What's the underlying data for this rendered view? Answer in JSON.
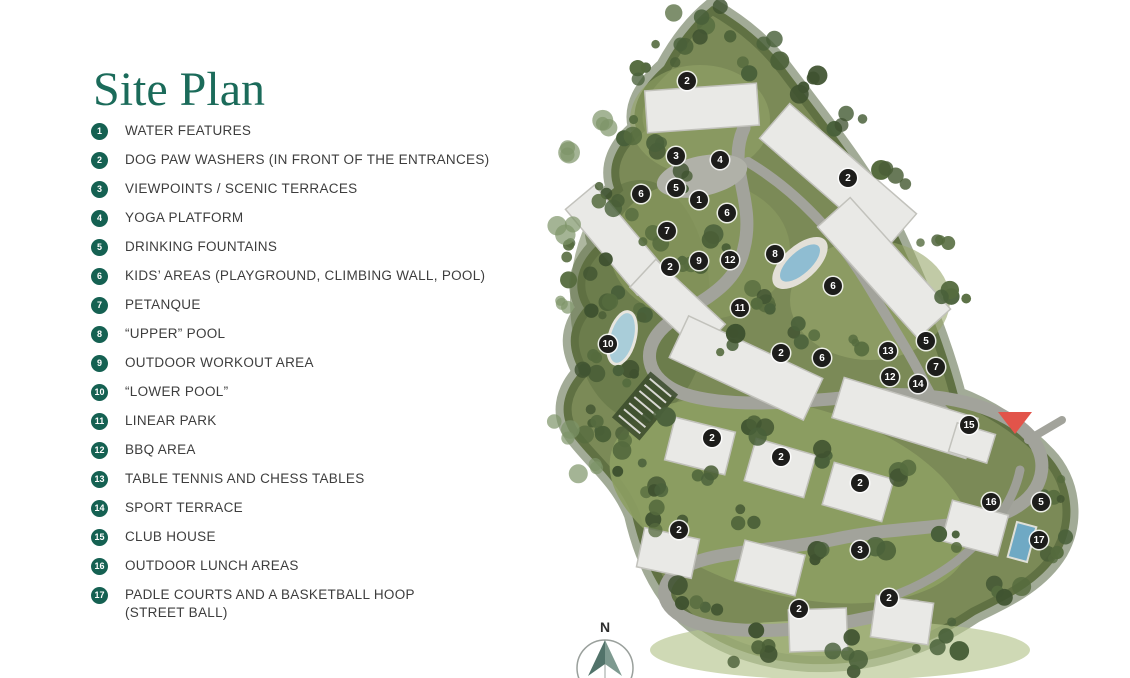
{
  "page": {
    "title": "Site Plan"
  },
  "legend": {
    "badge_color": "#156152",
    "items": [
      {
        "num": "1",
        "label": "WATER FEATURES"
      },
      {
        "num": "2",
        "label": "DOG PAW WASHERS (IN FRONT OF THE ENTRANCES)"
      },
      {
        "num": "3",
        "label": "VIEWPOINTS / SCENIC TERRACES"
      },
      {
        "num": "4",
        "label": "YOGA PLATFORM"
      },
      {
        "num": "5",
        "label": "DRINKING FOUNTAINS"
      },
      {
        "num": "6",
        "label": "KIDS’ AREAS (PLAYGROUND, CLIMBING WALL, POOL)"
      },
      {
        "num": "7",
        "label": "PETANQUE"
      },
      {
        "num": "8",
        "label": "“UPPER” POOL"
      },
      {
        "num": "9",
        "label": "OUTDOOR WORKOUT AREA"
      },
      {
        "num": "10",
        "label": "“LOWER POOL”"
      },
      {
        "num": "11",
        "label": "LINEAR PARK"
      },
      {
        "num": "12",
        "label": "BBQ AREA"
      },
      {
        "num": "13",
        "label": "TABLE TENNIS AND CHESS TABLES"
      },
      {
        "num": "14",
        "label": "SPORT TERRACE"
      },
      {
        "num": "15",
        "label": "CLUB HOUSE"
      },
      {
        "num": "16",
        "label": "OUTDOOR LUNCH AREAS"
      },
      {
        "num": "17",
        "label": "PADLE COURTS AND A BASKETBALL HOOP\n(STREET BALL)"
      }
    ]
  },
  "map": {
    "compass_label": "N",
    "marker_color": "#1d1d1b",
    "entrance_marker_color": "#e2544a",
    "title_color": "#1b6b5a",
    "markers": [
      {
        "label": "2",
        "x": 687,
        "y": 81
      },
      {
        "label": "3",
        "x": 676,
        "y": 156
      },
      {
        "label": "4",
        "x": 720,
        "y": 160
      },
      {
        "label": "2",
        "x": 848,
        "y": 178
      },
      {
        "label": "5",
        "x": 676,
        "y": 188
      },
      {
        "label": "6",
        "x": 641,
        "y": 194
      },
      {
        "label": "1",
        "x": 699,
        "y": 200
      },
      {
        "label": "6",
        "x": 727,
        "y": 213
      },
      {
        "label": "7",
        "x": 667,
        "y": 231
      },
      {
        "label": "8",
        "x": 775,
        "y": 254
      },
      {
        "label": "9",
        "x": 699,
        "y": 261
      },
      {
        "label": "12",
        "x": 730,
        "y": 260
      },
      {
        "label": "2",
        "x": 670,
        "y": 267
      },
      {
        "label": "6",
        "x": 833,
        "y": 286
      },
      {
        "label": "11",
        "x": 740,
        "y": 308
      },
      {
        "label": "5",
        "x": 926,
        "y": 341
      },
      {
        "label": "10",
        "x": 608,
        "y": 344
      },
      {
        "label": "13",
        "x": 888,
        "y": 351
      },
      {
        "label": "2",
        "x": 781,
        "y": 353
      },
      {
        "label": "6",
        "x": 822,
        "y": 358
      },
      {
        "label": "7",
        "x": 936,
        "y": 367
      },
      {
        "label": "12",
        "x": 890,
        "y": 377
      },
      {
        "label": "14",
        "x": 918,
        "y": 384
      },
      {
        "label": "15",
        "x": 969,
        "y": 425
      },
      {
        "label": "2",
        "x": 712,
        "y": 438
      },
      {
        "label": "2",
        "x": 781,
        "y": 457
      },
      {
        "label": "2",
        "x": 860,
        "y": 483
      },
      {
        "label": "16",
        "x": 991,
        "y": 502
      },
      {
        "label": "5",
        "x": 1041,
        "y": 502
      },
      {
        "label": "2",
        "x": 679,
        "y": 530
      },
      {
        "label": "17",
        "x": 1039,
        "y": 540
      },
      {
        "label": "3",
        "x": 860,
        "y": 550
      },
      {
        "label": "2",
        "x": 889,
        "y": 598
      },
      {
        "label": "2",
        "x": 799,
        "y": 609
      }
    ]
  }
}
